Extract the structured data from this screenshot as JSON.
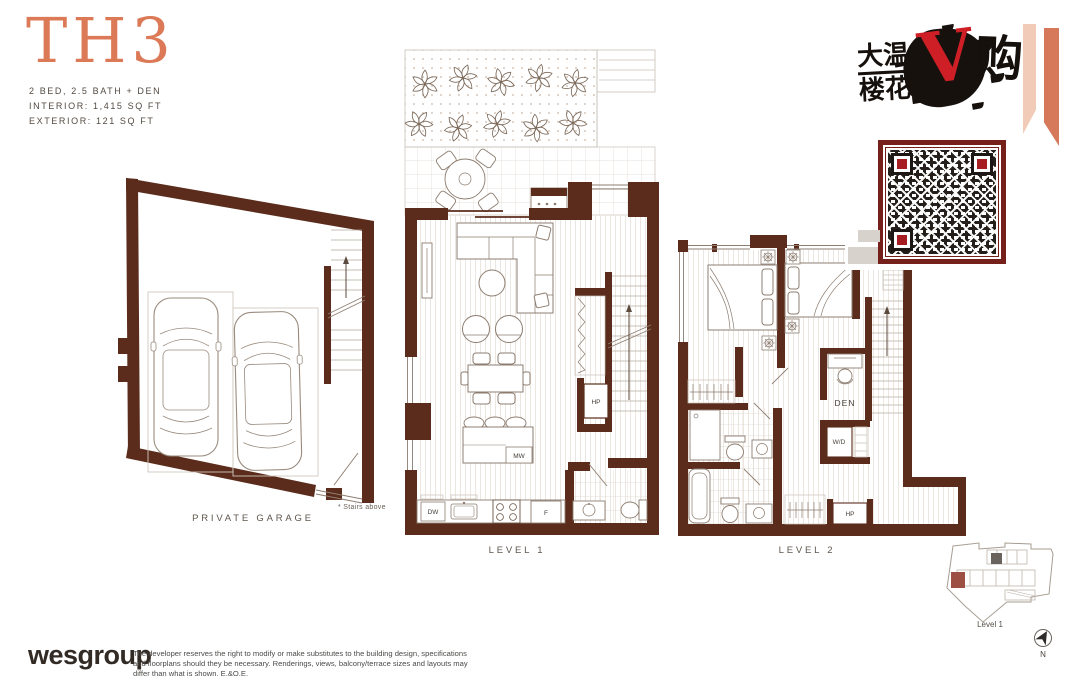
{
  "unit": {
    "title": "TH3",
    "spec_line1": "2 BED, 2.5 BATH + DEN",
    "spec_line2": "INTERIOR: 1,415 SQ FT",
    "spec_line3": "EXTERIOR: 121 SQ FT"
  },
  "garage": {
    "label": "PRIVATE GARAGE",
    "stairs_note": "* Stairs above"
  },
  "level1": {
    "label": "LEVEL 1",
    "hp": "HP",
    "mw": "MW",
    "dw": "DW",
    "fridge": "F"
  },
  "level2": {
    "label": "LEVEL 2",
    "den": "DEN",
    "wd": "W/D",
    "hp": "HP"
  },
  "watermark": {
    "cn_line1": "大温",
    "cn_line2": "楼花",
    "red_letter": "V",
    "cn_right": "购"
  },
  "keyplan": {
    "level_label": "Level 1",
    "north_label": "N"
  },
  "footer": {
    "brand": "wesgroup",
    "disclaimer_line1": "The developer reserves the right to modify or make substitutes to the building design, specifications and floorplans",
    "disclaimer_line2": "should they be necessary. Renderings, views, balcony/terrace sizes and layouts may differ than what is shown. E.&O.E."
  },
  "colors": {
    "wall": "#5b2c1c",
    "accent_coral": "#dc7a58",
    "qr_frame": "#76201b",
    "watermark_red": "#cf1f26",
    "keyplan_highlight": "#9c4f42"
  }
}
